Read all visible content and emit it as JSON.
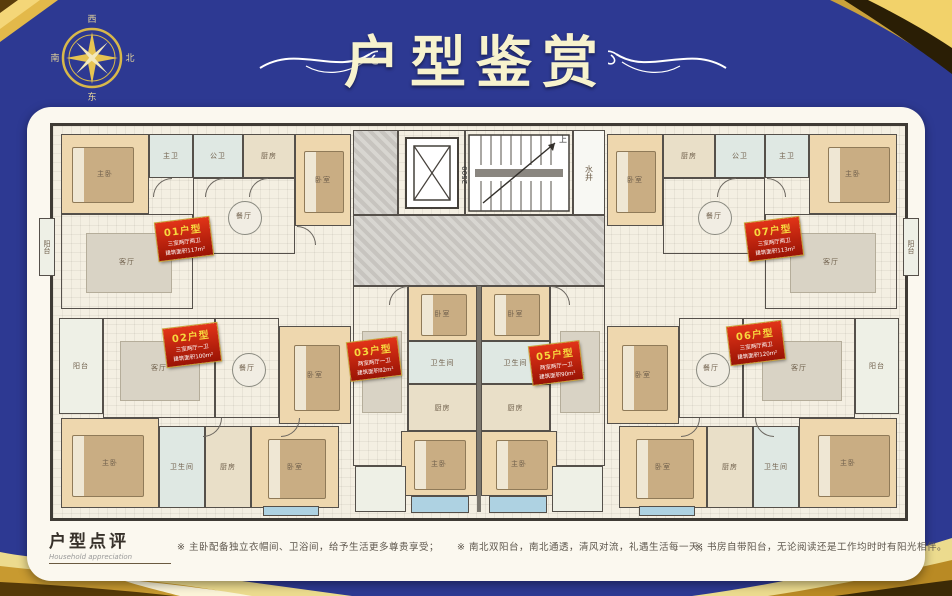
{
  "page": {
    "background_color": "#2d3992",
    "accent_gold": "#d8a63c",
    "panel_color": "#fbf8ef",
    "tag_red": "#c42311",
    "title_color": "#f7f2cd"
  },
  "header": {
    "title": "户型鉴赏",
    "compass": {
      "top": "西",
      "right": "北",
      "left": "南",
      "bottom": "东"
    }
  },
  "plan": {
    "core": {
      "stair_dim": "2500",
      "up": "上",
      "shaft": "水井"
    },
    "units": [
      {
        "tag": "01户型",
        "spec": "三室两厅两卫",
        "area": "建筑面积117m²",
        "rooms": {
          "master": "主卧",
          "mbath": "主卫",
          "pbath": "公卫",
          "kitchen": "厨房",
          "bed2": "卧室",
          "dining": "餐厅",
          "living": "客厅",
          "balcony": "阳台"
        }
      },
      {
        "tag": "02户型",
        "spec": "三室两厅一卫",
        "area": "建筑面积100m²",
        "rooms": {
          "balcony": "阳台",
          "living": "客厅",
          "dining": "餐厅",
          "bed2": "卧室",
          "master": "主卧",
          "bath": "卫生间",
          "kitchen": "厨房",
          "bed3": "卧室"
        }
      },
      {
        "tag": "03户型",
        "spec": "两室两厅一卫",
        "area": "建筑面积82m²",
        "rooms": {
          "bed": "卧室",
          "bath": "卫生间",
          "kitchen": "厨房",
          "master": "主卧",
          "living": "客厅"
        }
      },
      {
        "tag": "05户型",
        "spec": "两室两厅一卫",
        "area": "建筑面积90m²",
        "rooms": {
          "bed": "卧室",
          "bath": "卫生间",
          "kitchen": "厨房",
          "master": "主卧",
          "living": "客厅"
        }
      },
      {
        "tag": "06户型",
        "spec": "三室两厅两卫",
        "area": "建筑面积120m²",
        "rooms": {
          "bed": "卧室",
          "dining": "餐厅",
          "living": "客厅",
          "balcony": "阳台",
          "bed2": "卧室",
          "kitchen": "厨房",
          "bath": "卫生间",
          "master": "主卧"
        }
      },
      {
        "tag": "07户型",
        "spec": "三室两厅两卫",
        "area": "建筑面积113m²",
        "rooms": {
          "bed": "卧室",
          "kitchen": "厨房",
          "pbath": "公卫",
          "mbath": "主卫",
          "master": "主卧",
          "dining": "餐厅",
          "living": "客厅",
          "balcony": "阳台"
        }
      }
    ]
  },
  "footer": {
    "title": "户型点评",
    "subtitle": "Household appreciation",
    "notes": [
      "※ 主卧配备独立衣帽间、卫浴间，给予生活更多尊贵享受；",
      "※ 南北双阳台，南北通透，清风对流，礼遇生活每一天；",
      "※ 书房自带阳台，无论阅读还是工作均时时有阳光相伴。"
    ]
  }
}
